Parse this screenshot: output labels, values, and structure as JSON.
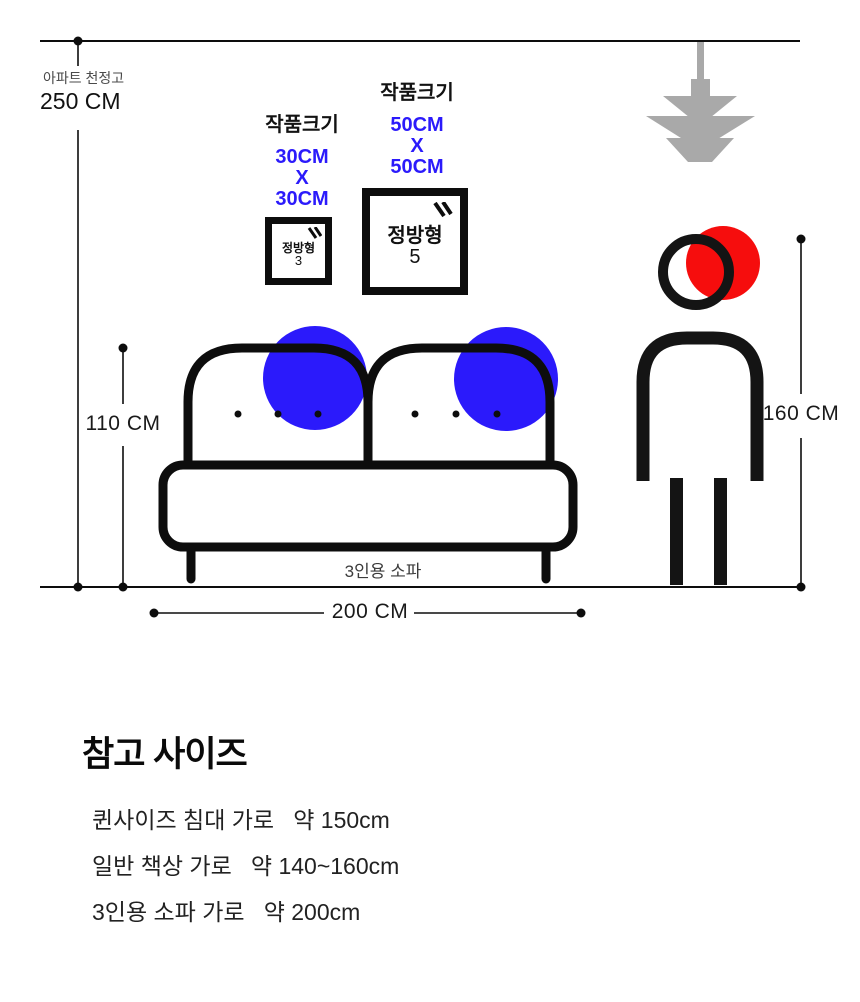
{
  "measurements": {
    "ceiling_label": "아파트 천정고",
    "ceiling_value": "250 CM",
    "sofa_height": "110 CM",
    "person_height": "160 CM",
    "sofa_width": "200 CM"
  },
  "artworks": [
    {
      "size_title": "작품크기",
      "dims": [
        "30CM",
        "X",
        "30CM"
      ],
      "frame_label": "정방형",
      "frame_number": "3"
    },
    {
      "size_title": "작품크기",
      "dims": [
        "50CM",
        "X",
        "50CM"
      ],
      "frame_label": "정방형",
      "frame_number": "5"
    }
  ],
  "sofa_caption": "3인용 소파",
  "reference": {
    "title": "참고 사이즈",
    "items": [
      "퀸사이즈 침대 가로   약 150cm",
      "일반 책상 가로   약 140~160cm",
      "3인용 소파 가로   약 200cm"
    ]
  },
  "icons": [
    "pendant-lamp-icon",
    "glare-icon",
    "person-figure",
    "sofa-figure"
  ],
  "colors": {
    "accent_blue": "#2b1afb",
    "accent_red": "#f60d0d",
    "lamp_gray": "#a9a9a9",
    "line_black": "#0d0d0d"
  }
}
